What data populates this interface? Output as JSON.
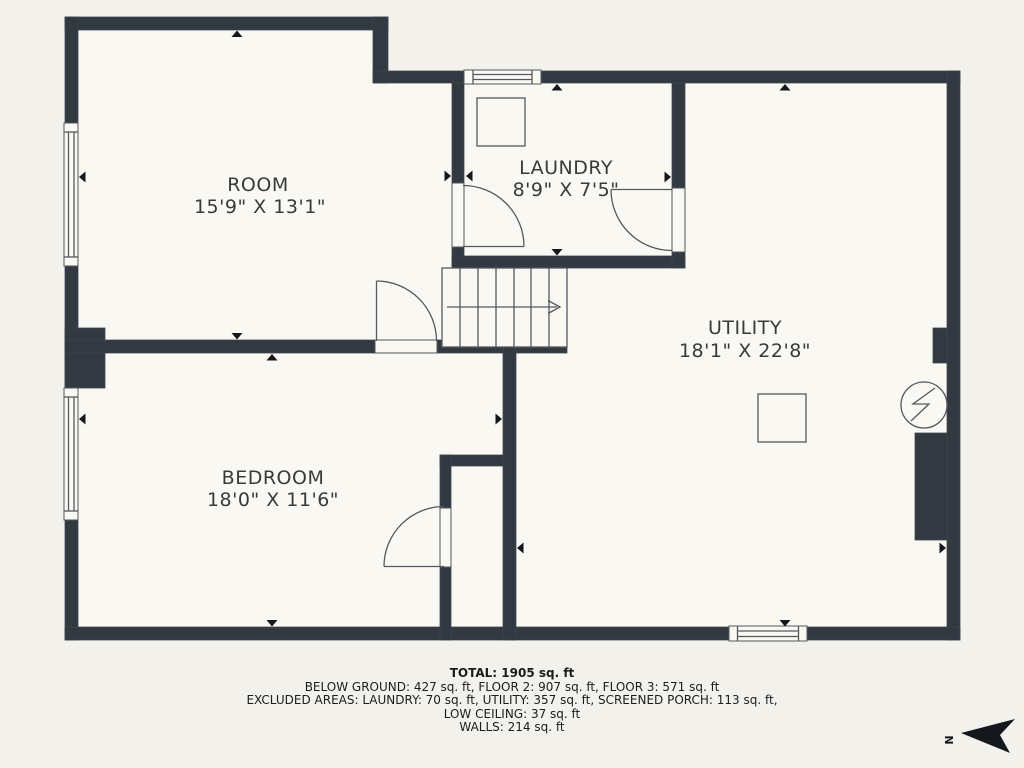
{
  "plan": {
    "background_color": "#f2f1eb",
    "floor_color": "#f9f8f2",
    "wall_color": "#323941",
    "line_color": "#54595f",
    "text_color": "#3a3a3a"
  },
  "rooms": [
    {
      "id": "room",
      "name": "ROOM",
      "dimensions": "15'9\" X 13'1\""
    },
    {
      "id": "laundry",
      "name": "LAUNDRY",
      "dimensions": "8'9\" X 7'5\""
    },
    {
      "id": "utility",
      "name": "UTILITY",
      "dimensions": "18'1\" X 22'8\""
    },
    {
      "id": "bedroom",
      "name": "BEDROOM",
      "dimensions": "18'0\" X 11'6\""
    }
  ],
  "footer": {
    "total": "TOTAL: 1905 sq. ft",
    "line1": "BELOW GROUND: 427 sq. ft, FLOOR 2: 907 sq. ft, FLOOR 3: 571 sq. ft",
    "line2": "EXCLUDED AREAS: LAUNDRY: 70 sq. ft, UTILITY: 357 sq. ft, SCREENED PORCH: 113 sq. ft,",
    "line3": "LOW CEILING: 37 sq. ft",
    "line4": "WALLS: 214 sq. ft"
  },
  "compass": {
    "label": "N"
  }
}
